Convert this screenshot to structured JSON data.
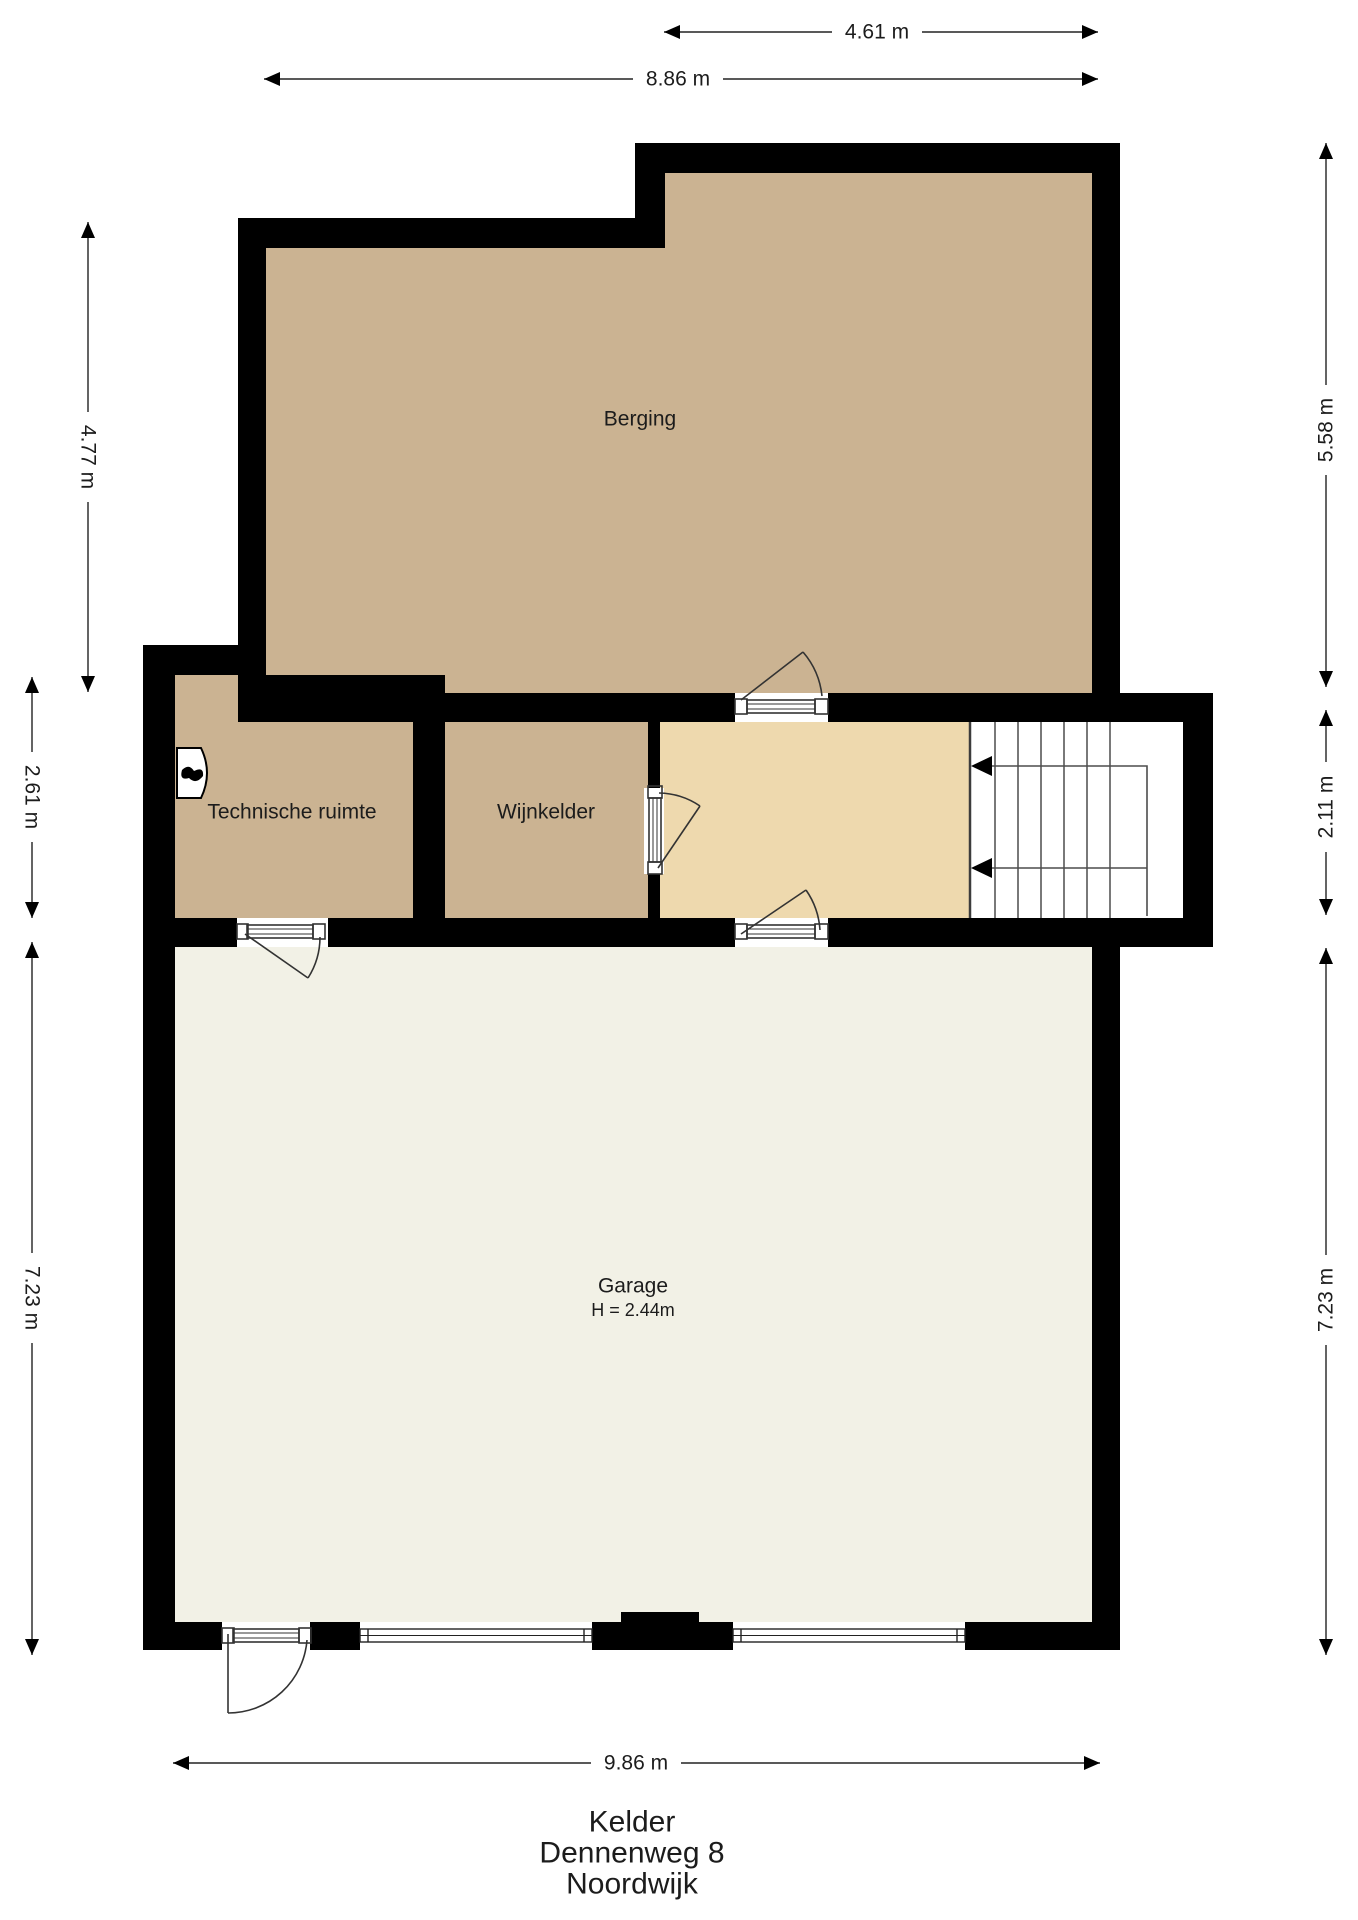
{
  "plan": {
    "rooms": [
      {
        "name": "Berging"
      },
      {
        "name": "Technische ruimte"
      },
      {
        "name": "Wijnkelder"
      },
      {
        "name": "Garage",
        "height_note": "H = 2.44m"
      }
    ]
  },
  "dimensions": {
    "top": [
      {
        "label": "4.61 m"
      },
      {
        "label": "8.86 m"
      }
    ],
    "left": [
      {
        "label": "4.77 m"
      },
      {
        "label": "2.61 m"
      },
      {
        "label": "7.23 m"
      }
    ],
    "right": [
      {
        "label": "5.58 m"
      },
      {
        "label": "2.11 m"
      },
      {
        "label": "7.23 m"
      }
    ],
    "bottom": [
      {
        "label": "9.86 m"
      }
    ]
  },
  "footer": {
    "lines": [
      "Kelder",
      "Dennenweg 8",
      "Noordwijk"
    ]
  },
  "colors": {
    "wall": "#000000",
    "room_tan": "#cbb392",
    "hall_tan": "#eed9ae",
    "garage_floor": "#f2f1e6",
    "line": "#3c3c3c"
  }
}
